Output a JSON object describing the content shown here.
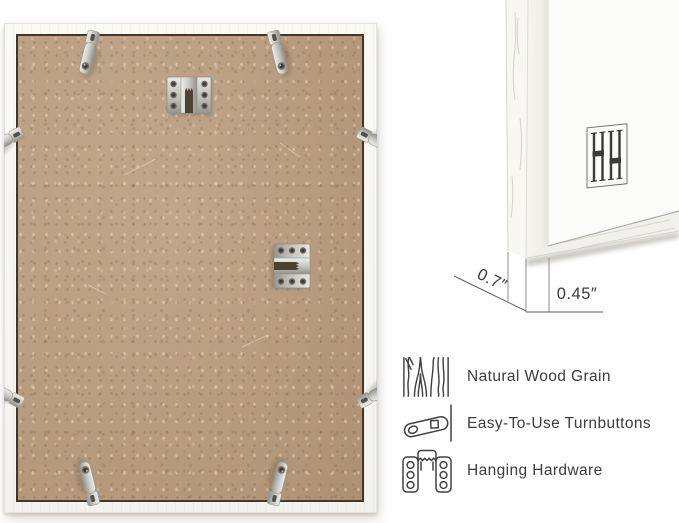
{
  "colors": {
    "page_background": "#ffffff",
    "frame_white": "#f7f6f3",
    "backing_tan": "#c0a385",
    "metal_silver": "#c9c8c2",
    "line_dark": "#3d3d3c"
  },
  "frame_back_photo": {
    "description": "Back of white picture frame with MDF backing",
    "turnbutton_count": 8,
    "sawtooth_hanger_count": 2
  },
  "corner_detail": {
    "logo": "hh-monogram",
    "dim_depth": "0.7″",
    "dim_face": "0.45″"
  },
  "features": [
    {
      "icon": "wood-grain-icon",
      "label": "Natural Wood Grain"
    },
    {
      "icon": "turnbutton-icon",
      "label": "Easy-To-Use Turnbuttons"
    },
    {
      "icon": "hanging-hardware-icon",
      "label": "Hanging Hardware"
    }
  ]
}
